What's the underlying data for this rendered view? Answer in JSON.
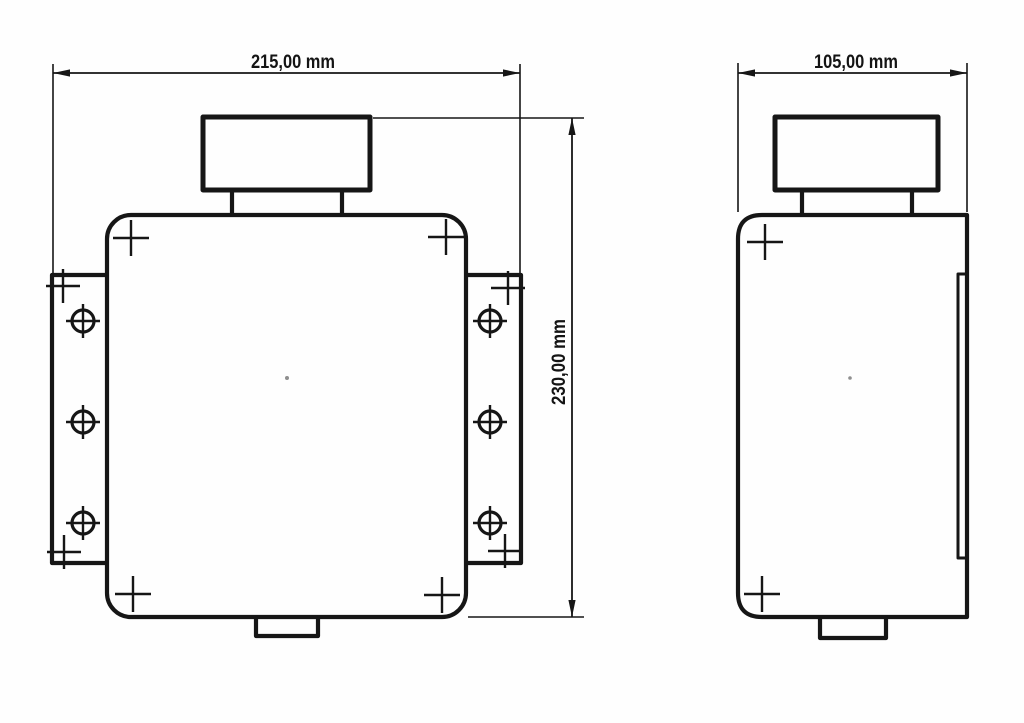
{
  "drawing": {
    "kind": "mechanical-dimension-drawing",
    "background_color": "#fefefe",
    "line_color": "#161616",
    "views": {
      "front": {
        "name": "front-view",
        "width_label": "215,00 mm",
        "height_label": "230,00 mm",
        "mounting_hole_count": 6,
        "corner_mark_count": 4,
        "flange_mark_count": 4
      },
      "side": {
        "name": "side-view",
        "width_label": "105,00 mm",
        "corner_mark_count": 2
      }
    }
  }
}
